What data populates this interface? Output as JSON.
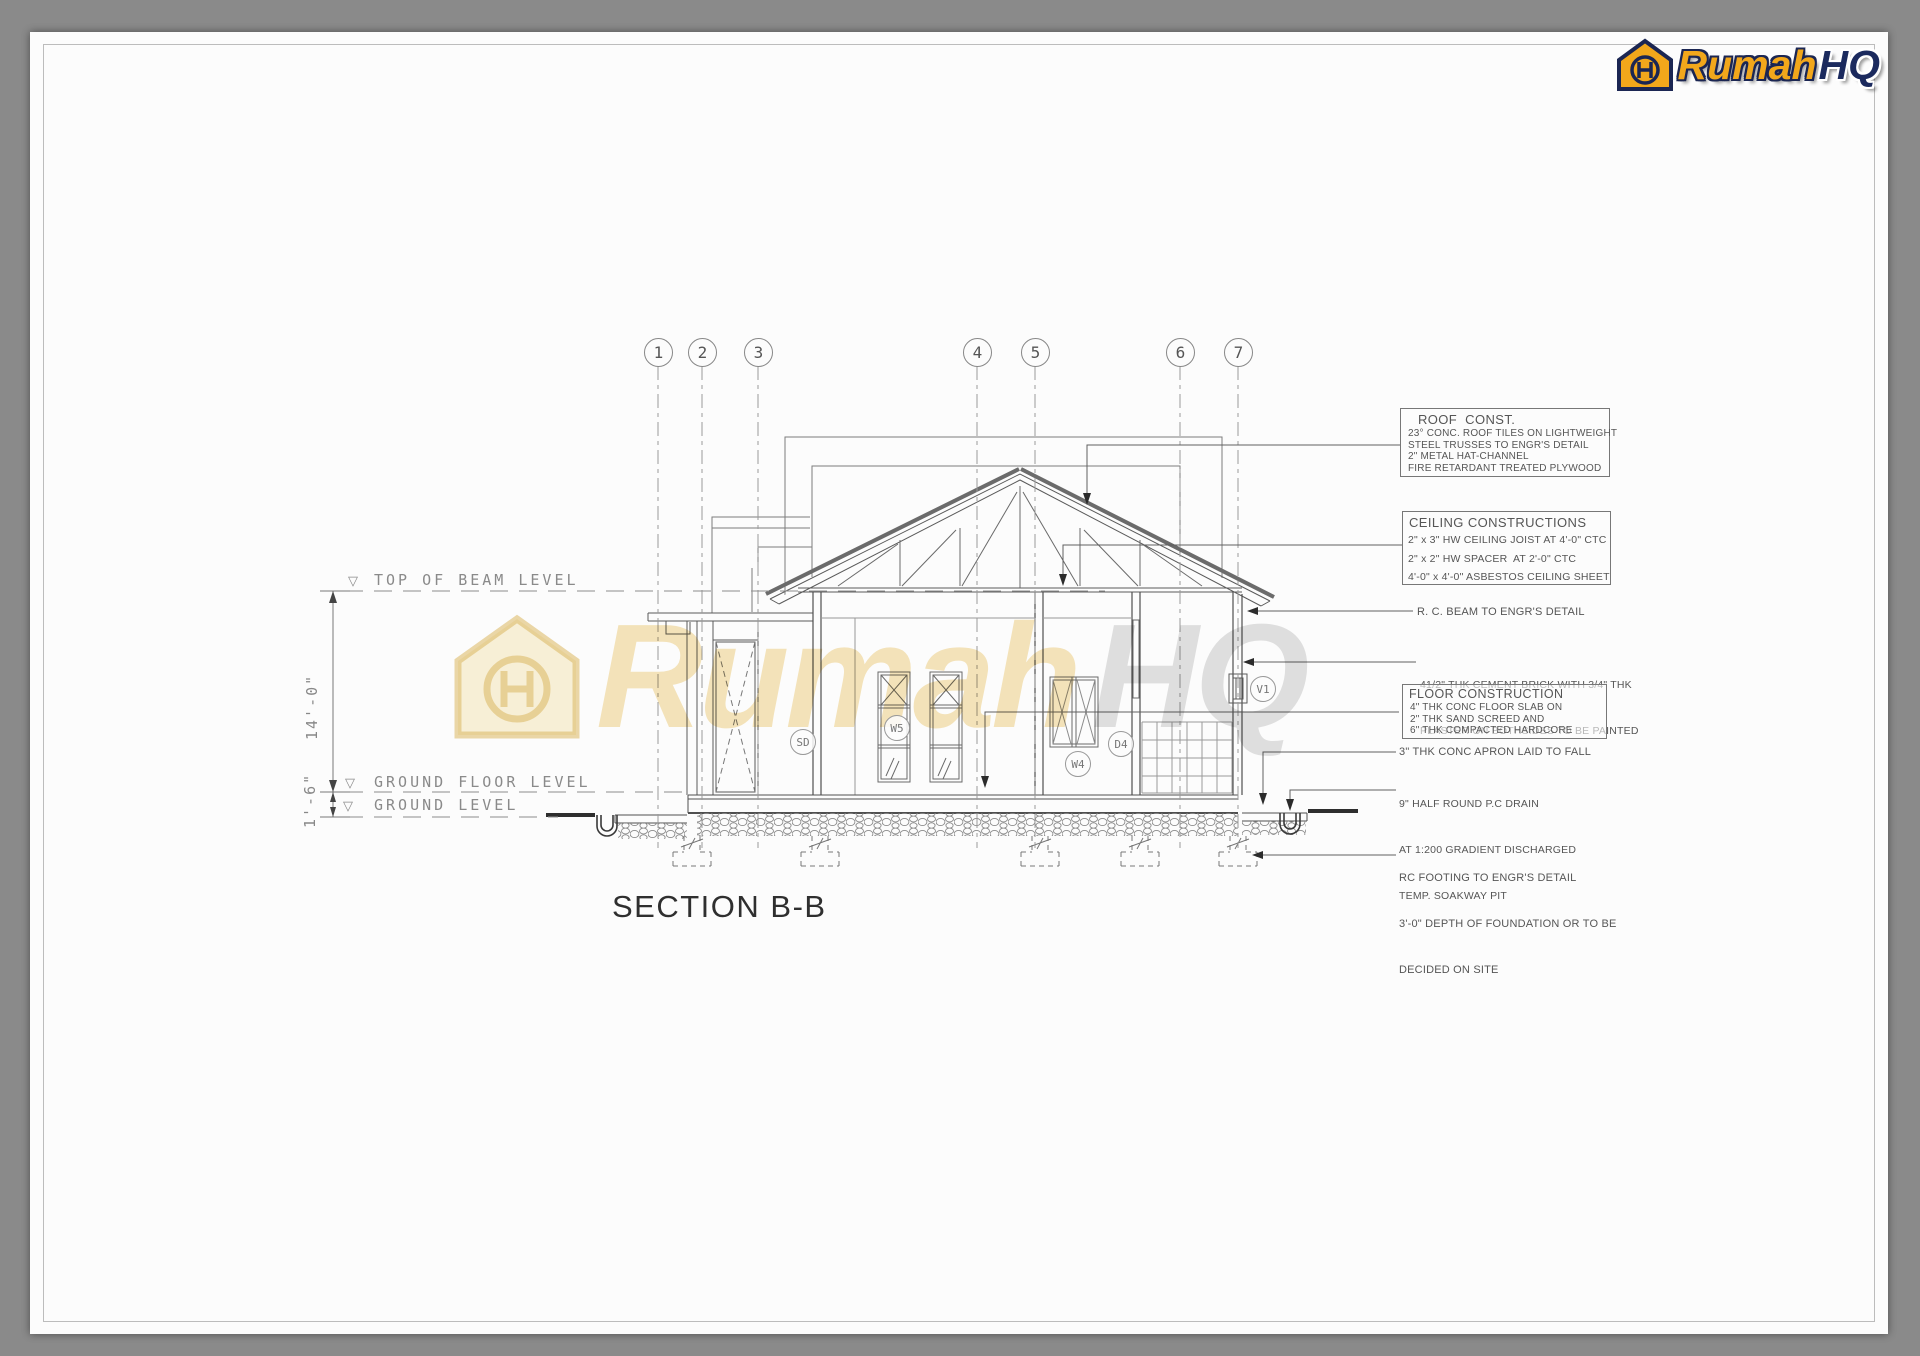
{
  "logo": {
    "brand_primary": "Rumah",
    "brand_secondary": "HQ"
  },
  "watermark": {
    "primary": "Rumah",
    "secondary": "HQ"
  },
  "title": "SECTION B-B",
  "grid": {
    "bubbles": [
      "1",
      "2",
      "3",
      "4",
      "5",
      "6",
      "7"
    ]
  },
  "levels": {
    "top_of_beam": "TOP OF BEAM LEVEL",
    "ground_floor": "GROUND FLOOR LEVEL",
    "ground": "GROUND LEVEL",
    "marker": "▽"
  },
  "dimensions": {
    "beam_to_floor": "14'-0\"",
    "floor_to_ground": "1'-6\""
  },
  "tags": {
    "sliding_door": "SD",
    "window_w5": "W5",
    "window_w4": "W4",
    "door_d4": "D4",
    "vent_v1": "V1"
  },
  "annotations": {
    "roof": {
      "title": "ROOF  CONST.",
      "lines": [
        "23° CONC. ROOF TILES ON LIGHTWEIGHT",
        "STEEL TRUSSES TO ENGR'S DETAIL",
        "2\" METAL HAT-CHANNEL",
        "FIRE RETARDANT TREATED PLYWOOD"
      ]
    },
    "ceiling": {
      "title": "CEILING CONSTRUCTIONS",
      "lines": [
        "2\" x 3\" HW CEILING JOIST AT 4'-0\" CTC",
        "2\" x 2\" HW SPACER  AT 2'-0\" CTC",
        "4'-0\" x 4'-0\" ASBESTOS CEILING SHEET"
      ]
    },
    "rc_beam": "R. C. BEAM TO ENGR'S DETAIL",
    "brick_line1": "41/2\" THK CEMENT BRICK WITH 3/4\" THK",
    "brick_line2": "PLASTER ON BOTHSIDES TO BE PAINTED",
    "floor": {
      "title": "FLOOR CONSTRUCTION",
      "lines": [
        "4\" THK CONC FLOOR SLAB ON",
        "2\" THK SAND SCREED AND",
        "6\" THK COMPACTED HARDCORE"
      ]
    },
    "apron": "3\" THK CONC APRON LAID TO FALL",
    "drain_line1": "9\" HALF ROUND P.C DRAIN",
    "drain_line2": "AT 1:200 GRADIENT DISCHARGED",
    "drain_line3": "TEMP. SOAKWAY PIT",
    "footing_line1": "RC FOOTING TO ENGR'S DETAIL",
    "footing_line2": "3'-0\" DEPTH OF FOUNDATION OR TO BE",
    "footing_line3": "DECIDED ON SITE"
  },
  "colors": {
    "brand_gold": "#f2a71b",
    "brand_navy": "#1b2653",
    "line": "#5a5a5a",
    "sheet": "#fcfcfc",
    "surround": "#8a8a8a"
  }
}
